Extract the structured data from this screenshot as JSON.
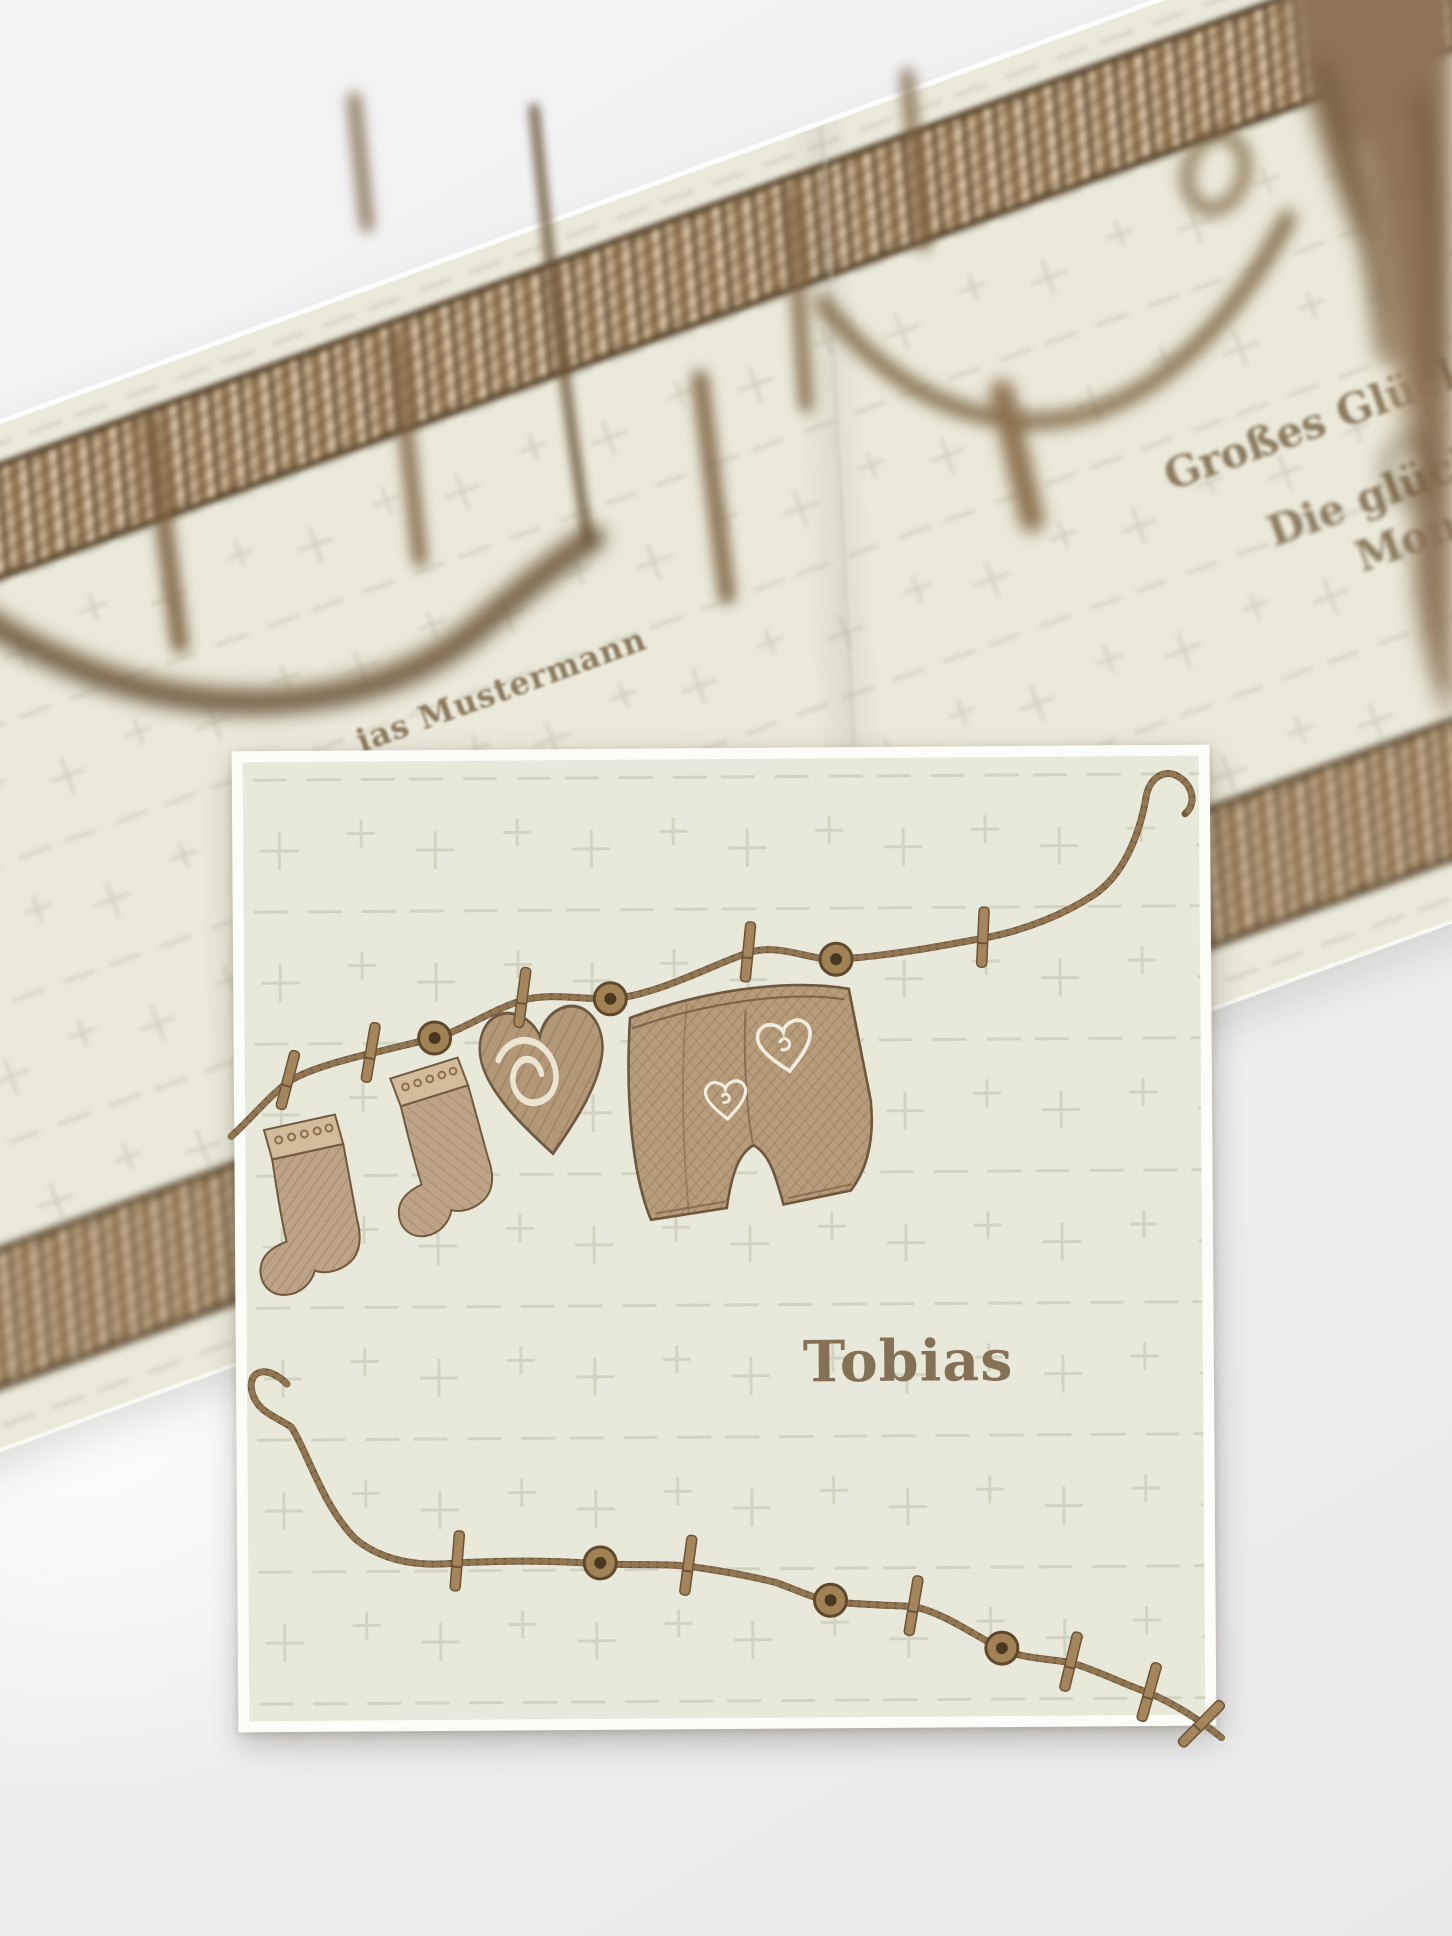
{
  "background_card": {
    "left_panel": {
      "name_text": "ias Mustermann"
    },
    "right_panel": {
      "line1": "Großes Glück kann s",
      "line2": "Die glücklich",
      "line3": "Mona u"
    }
  },
  "foreground_card": {
    "name_text": "Tobias",
    "illustration": {
      "items": [
        "knit-sock",
        "knit-sock",
        "knit-heart",
        "knit-pants"
      ],
      "decorations": [
        "clothesline-rope",
        "clothespins",
        "wooden-buttons",
        "white-hearts"
      ]
    }
  },
  "colors": {
    "backdrop": "#f0f0f2",
    "card_cream": "#e8e9da",
    "text_brown": "#8b7a5f",
    "title_brown": "#857155",
    "rope_brown": "#6f5639",
    "pin_wood": "#a5855c",
    "band_brown": "#a98e6a"
  }
}
